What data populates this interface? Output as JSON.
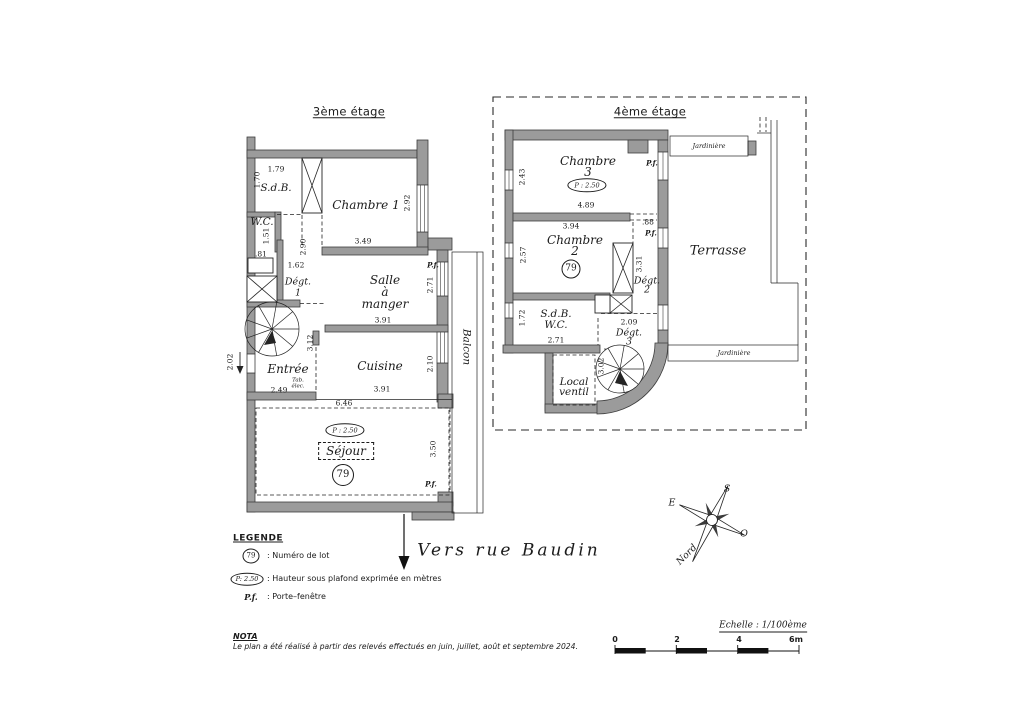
{
  "floor3": {
    "title": "3ème étage",
    "labels": {
      "sdb": "S.d.B.",
      "wc": "W.C.",
      "chambre1": "Chambre 1",
      "degt1_l1": "Dégt.",
      "degt1_l2": "1",
      "salle_l1": "Salle",
      "salle_l2": "à",
      "salle_l3": "manger",
      "cuisine": "Cuisine",
      "entree": "Entrée",
      "tab_elec_l1": "Tab.",
      "tab_elec_l2": "élec.",
      "sejour": "Séjour",
      "balcon": "Balcon",
      "ceiling_height": "P : 2.50",
      "lot_number": "79",
      "pf_top": "P.f.",
      "pf_bottom": "P.f."
    },
    "dims": {
      "sdb_w": "1.79",
      "sdb_h": "1.70",
      "wc_h": "1.51",
      "wc_w": ".81",
      "chambre1_w": "3.49",
      "chambre1_h": "2.92",
      "hall_h": "2.90",
      "degt1_w": "1.62",
      "salle_w": "3.91",
      "salle_h": "2.71",
      "cuisine_w": "3.91",
      "cuisine_h": "2.10",
      "entree_w": "2.49",
      "entree_h": "3.12",
      "door_h": "2.02",
      "sejour_w": "6.46",
      "sejour_h": "3.50"
    }
  },
  "floor4": {
    "title": "4ème étage",
    "labels": {
      "chambre3_l1": "Chambre",
      "chambre3_l2": "3",
      "chambre2_l1": "Chambre",
      "chambre2_l2": "2",
      "sdbwc_l1": "S.d.B.",
      "sdbwc_l2": "W.C.",
      "degt2_l1": "Dégt.",
      "degt2_l2": "2",
      "degt3_l1": "Dégt.",
      "degt3_l2": "3",
      "local_l1": "Local",
      "local_l2": "ventil",
      "terrasse": "Terrasse",
      "jardiniere_top": "Jardinière",
      "jardiniere_bottom": "Jardinière",
      "ceiling_height": "P : 2.50",
      "lot_number": "79",
      "pf_chambre3": "P.f.",
      "pf_terrasse": "P.f."
    },
    "dims": {
      "chambre3_h": "2.43",
      "chambre3_w": "4.89",
      "chambre2_top": "3.94",
      "chambre2_h": "2.57",
      "door_w": ".88",
      "degt2_h": "3.31",
      "sdbwc_h": "1.72",
      "sdbwc_w": "2.71",
      "degt3_w": "2.09",
      "stair": "3.02"
    }
  },
  "street": {
    "label": "Vers rue Baudin"
  },
  "compass": {
    "n": "Nord",
    "s": "S",
    "e": "E",
    "o": "O"
  },
  "legend": {
    "title": "LEGENDE",
    "lot_symbol": "79",
    "lot_text": ":  Numéro de lot",
    "ceiling_symbol": "P: 2.50",
    "ceiling_text": ":  Hauteur sous plafond exprimée en mètres",
    "pf_symbol": "P.f.",
    "pf_text": ":  Porte–fenêtre"
  },
  "nota": {
    "title": "NOTA",
    "text": "Le plan a été réalisé à partir des relevés effectués en juin, juillet, août et septembre 2024."
  },
  "scale": {
    "label": "Echelle : 1/100ème",
    "ticks": [
      "0",
      "2",
      "4",
      "6m"
    ]
  }
}
